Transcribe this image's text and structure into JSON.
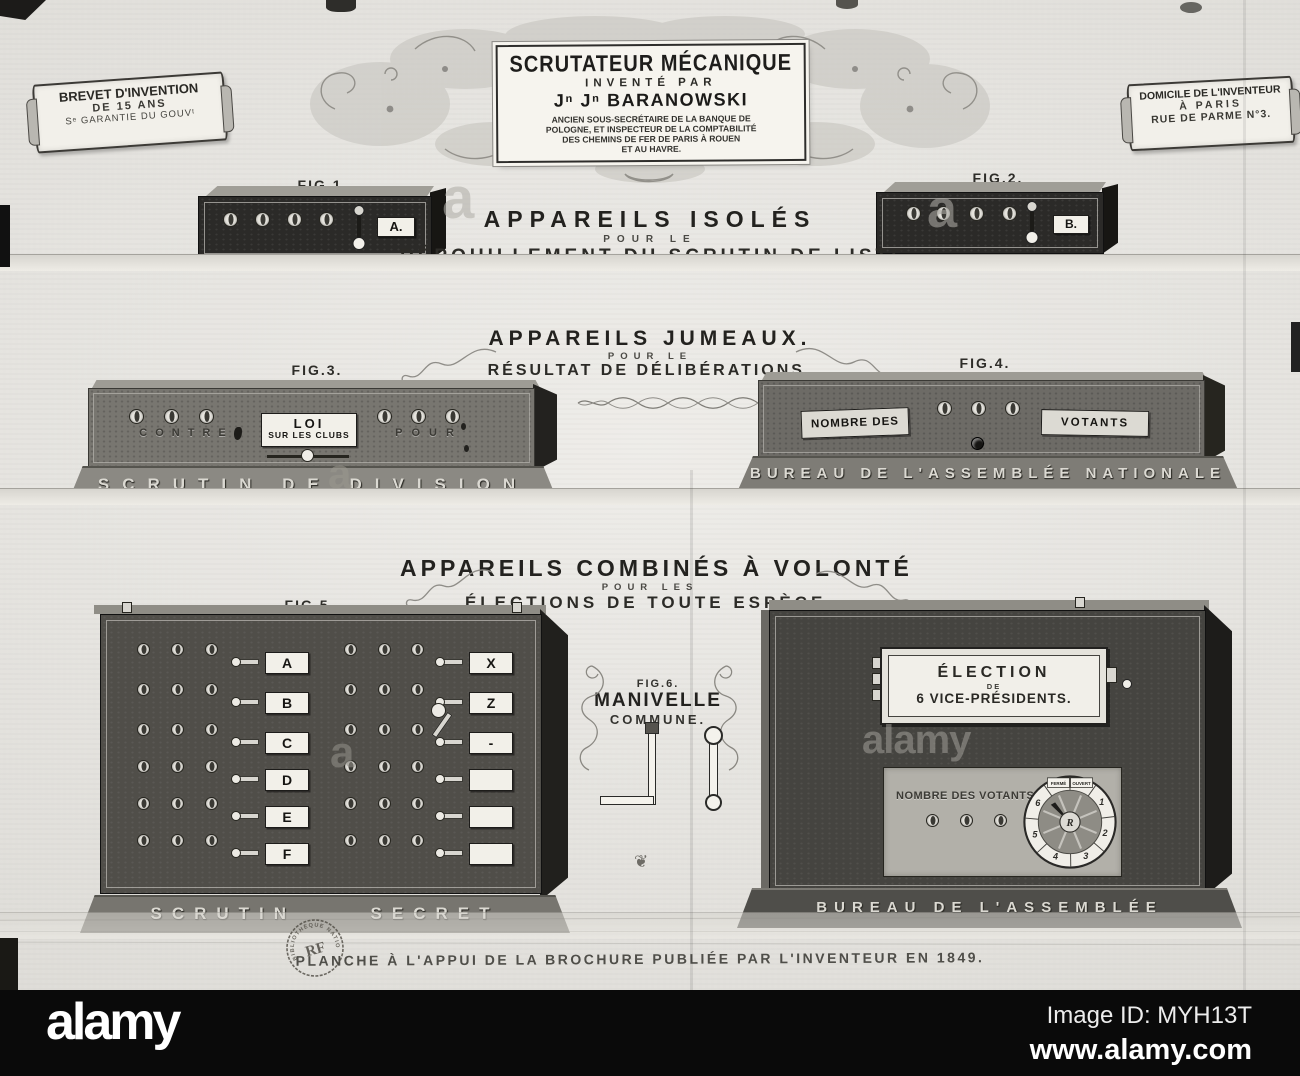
{
  "colors": {
    "paper": "#e9e7e2",
    "bar": "#0a0a0a",
    "ink": "#23221f",
    "machine_dark": "#2b2a28",
    "machine_grey": "#787670",
    "plate": "#f2f0e9"
  },
  "alamy_bar": {
    "logo": "alamy",
    "image_id": "Image ID: MYH13T",
    "url": "www.alamy.com"
  },
  "ghost": {
    "letter": "a",
    "word": "alamy"
  },
  "banner_left": {
    "l1": "BREVET D'INVENTION",
    "l2": "DE 15 ANS",
    "l3": "Sᵉ GARANTIE DU GOUVᵗ"
  },
  "banner_right": {
    "l1": "DOMICILE DE L'INVENTEUR",
    "l2": "À PARIS",
    "l3": "RUE DE PARME N°3."
  },
  "cartouche": {
    "title": "SCRUTATEUR MÉCANIQUE",
    "sub": "INVENTÉ PAR",
    "inventor": "Jⁿ Jⁿ BARANOWSKI",
    "cred1": "ANCIEN SOUS-SECRÉTAIRE DE LA BANQUE DE",
    "cred2": "POLOGNE, ET INSPECTEUR DE LA COMPTABILITÉ",
    "cred3": "DES CHEMINS DE FER DE PARIS À ROUEN",
    "cred4": "ET AU HAVRE."
  },
  "figs": {
    "f1": "FIG.1.",
    "f2": "FIG.2.",
    "f3": "FIG.3.",
    "f4": "FIG.4.",
    "f5": "FIG.5.",
    "f6": "FIG.6.",
    "f7": "FIG.7."
  },
  "s1": {
    "h": "APPAREILS ISOLÉS",
    "pour": "POUR LE",
    "sub": "DÉPOUILLEMENT DU SCRUTIN DE LISTE",
    "a": "A.",
    "b": "B."
  },
  "s2": {
    "h": "APPAREILS JUMEAUX.",
    "pour": "POUR LE",
    "sub": "RÉSULTAT DE DÉLIBÉRATIONS.",
    "contre": "CONTRE",
    "pour_lbl": "POUR",
    "plaque1": "LOI",
    "plaque2": "SUR LES CLUBS",
    "base3": "SCRUTIN DE DIVISION",
    "nombre": "NOMBRE DES",
    "votants": "VOTANTS",
    "base4": "BUREAU DE L'ASSEMBLÉE NATIONALE"
  },
  "s3": {
    "h": "APPAREILS COMBINÉS À VOLONTÉ",
    "pour": "POUR LES",
    "sub": "ÉLECTIONS DE TOUTE ESPÈCE.",
    "left_labels": [
      "A",
      "B",
      "C",
      "D",
      "E",
      "F"
    ],
    "right_labels": [
      "X",
      "Z",
      "-",
      "",
      "",
      ""
    ],
    "base5a": "SCRUTIN",
    "base5b": "SECRET",
    "f6_title": "MANIVELLE",
    "f6_sub": "COMMUNE.",
    "plaque7a": "ÉLECTION",
    "plaque7b": "DE",
    "plaque7c": "6 VICE-PRÉSIDENTS.",
    "panel_label": "NOMBRE DES VOTANTS",
    "dial": {
      "ferme": "FERMÉ",
      "ouvert": "OUVERT",
      "numbers": [
        "1",
        "2",
        "3",
        "4",
        "5",
        "6"
      ],
      "hub": "R"
    },
    "base7": "BUREAU DE L'ASSEMBLÉE NATIONALE",
    "ornament_glyph": "❦"
  },
  "footer": {
    "caption": "PLANCHE À L'APPUI DE LA BROCHURE PUBLIÉE PAR L'INVENTEUR EN 1849.",
    "stamp_center": "RF",
    "stamp_ring": "BIBLIOTHÈQUE NATIONALE"
  }
}
